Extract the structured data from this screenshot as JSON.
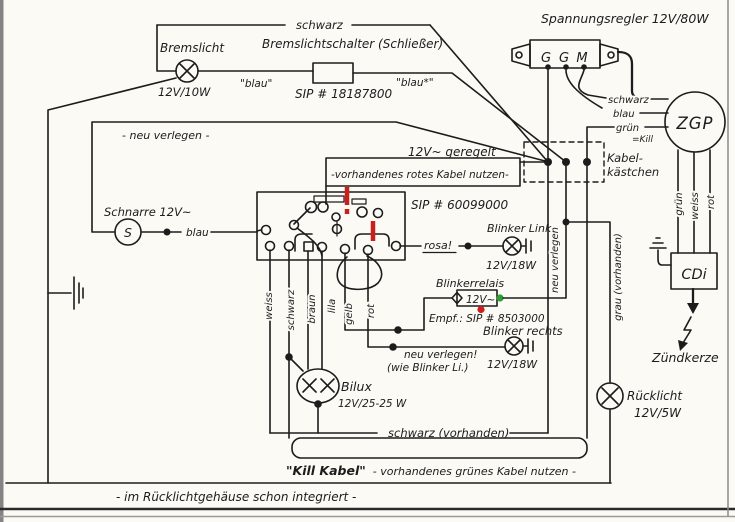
{
  "colors": {
    "ink": "#1c1c1c",
    "red": "#c9201d",
    "green": "#2f9e2f",
    "paper": "#fbfaf5"
  },
  "brake": {
    "lamp_label": "Bremslicht",
    "lamp_watt": "12V/10W",
    "wire_top": "schwarz",
    "switch_label": "Bremslichtschalter (Schließer)",
    "switch_part": "SIP # 18187800",
    "wire_blau_left": "\"blau\"",
    "wire_blau_right": "\"blau*\""
  },
  "regulator": {
    "title": "Spannungsregler 12V/80W",
    "t1": "G",
    "t2": "G",
    "t3": "M",
    "wire_schwarz": "schwarz",
    "wire_blau": "blau",
    "wire_gruen": "grün",
    "wire_kill": "=Kill"
  },
  "zgp": {
    "label": "ZGP",
    "wire_gruen": "grün",
    "wire_weiss": "weiss",
    "wire_rot": "rot"
  },
  "kabelkasten": {
    "line1": "Kabel-",
    "line2": "kästchen"
  },
  "cdi": {
    "label": "CDi",
    "spark": "Zündkerze"
  },
  "supply": {
    "neu_verlegen": "- neu verlegen -",
    "geregelt": "12V~ geregelt",
    "rotes_kabel": "-vorhandenes rotes Kabel nutzen-"
  },
  "horn": {
    "label": "Schnarre 12V~",
    "symbol": "S",
    "wire": "blau"
  },
  "switchbox": {
    "part": "SIP # 60099000",
    "rosa": "rosa!",
    "w_weiss": "weiss",
    "w_schwarz": "schwarz",
    "w_braun": "braun",
    "w_lila": "lila",
    "w_gelb": "gelb",
    "w_rot": "rot"
  },
  "blinker": {
    "links": "Blinker Links",
    "links_watt": "12V/18W",
    "relais": "Blinkerrelais",
    "relais_v": "12V~",
    "empf": "Empf.: SIP # 8503000",
    "rechts": "Blinker rechts",
    "rechts_watt": "12V/18W",
    "neu1": "neu verlegen!",
    "neu2": "(wie Blinker Li.)"
  },
  "bilux": {
    "label": "Bilux",
    "watt": "12V/25-25 W"
  },
  "tail": {
    "ruecklicht": "Rücklicht",
    "watt": "12V/5W",
    "hinweis": "- im Rücklichtgehäuse schon integriert -"
  },
  "wires": {
    "schwarz_vorhanden": "schwarz (vorhanden)",
    "kill_q": "\"Kill Kabel\"",
    "kill_rest": "- vorhandenes grünes Kabel nutzen -",
    "neu_verlegen_vert": "neu verlegen",
    "grau_vorhanden": "grau (vorhanden)"
  }
}
